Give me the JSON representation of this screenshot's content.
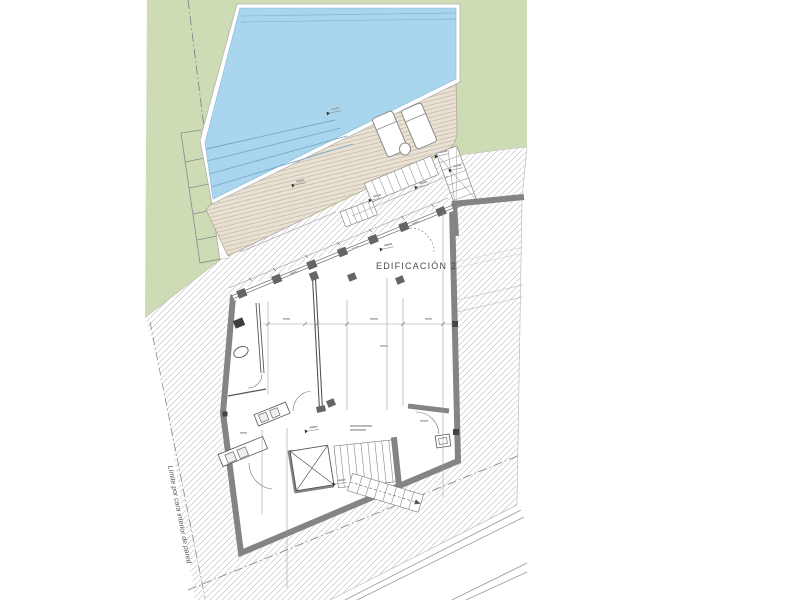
{
  "labels": {
    "building": "EDIFICACIÓN 2",
    "boundary": "Límite por cara interior de pared"
  },
  "colors": {
    "paper": "#ffffff",
    "lawn": "#cddcb5",
    "pool": "#a9d5ee",
    "pool_line": "#74a9cb",
    "deck": "#e9e2d4",
    "deck_line": "#c6baa7",
    "deck_edge": "#cf9a6c",
    "hatch_line": "#c9c9c9",
    "wall": "#848484",
    "pillar": "#656565",
    "detail": "#555555",
    "dim": "#999999"
  }
}
